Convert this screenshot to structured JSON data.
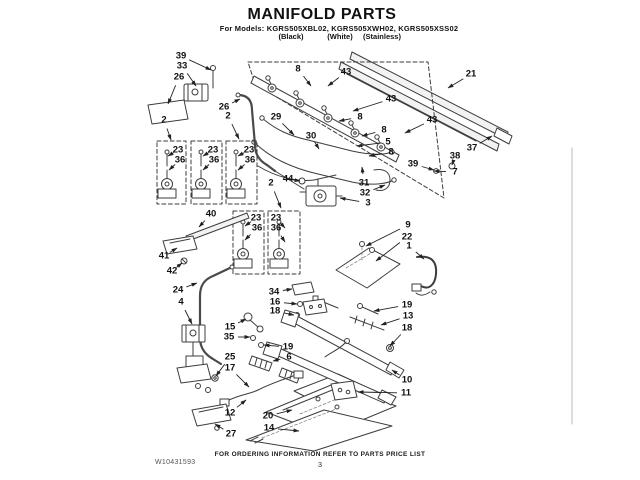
{
  "header": {
    "title": "MANIFOLD PARTS",
    "models_line": "For Models: KGRS505XBL02, KGRS505XWH02, KGRS505XSS02",
    "finishes": [
      "(Black)",
      "(White)",
      "(Stainless)"
    ]
  },
  "footer": {
    "ordering_note": "FOR ORDERING INFORMATION REFER TO PARTS PRICE LIST",
    "page_number": "3",
    "document_number": "W10431593"
  },
  "diagram": {
    "callouts": [
      {
        "label": "39",
        "x": 181,
        "y": 56,
        "tx": 211,
        "ty": 70
      },
      {
        "label": "33",
        "x": 182,
        "y": 66,
        "tx": 196,
        "ty": 86
      },
      {
        "label": "26",
        "x": 179,
        "y": 77,
        "tx": 168,
        "ty": 104
      },
      {
        "label": "26",
        "x": 224,
        "y": 107,
        "tx": 240,
        "ty": 99
      },
      {
        "label": "2",
        "x": 164,
        "y": 120,
        "tx": 171,
        "ty": 140
      },
      {
        "label": "2",
        "x": 228,
        "y": 116,
        "tx": 239,
        "ty": 139
      },
      {
        "label": "8",
        "x": 298,
        "y": 69,
        "tx": 311,
        "ty": 86
      },
      {
        "label": "43",
        "x": 346,
        "y": 72,
        "tx": 328,
        "ty": 86
      },
      {
        "label": "21",
        "x": 471,
        "y": 74,
        "tx": 448,
        "ty": 88
      },
      {
        "label": "43",
        "x": 391,
        "y": 99,
        "tx": 353,
        "ty": 111
      },
      {
        "label": "8",
        "x": 360,
        "y": 117,
        "tx": 339,
        "ty": 121
      },
      {
        "label": "43",
        "x": 432,
        "y": 120,
        "tx": 405,
        "ty": 133
      },
      {
        "label": "8",
        "x": 384,
        "y": 130,
        "tx": 362,
        "ty": 136
      },
      {
        "label": "5",
        "x": 388,
        "y": 142,
        "tx": 357,
        "ty": 146
      },
      {
        "label": "8",
        "x": 391,
        "y": 152,
        "tx": 369,
        "ty": 156
      },
      {
        "label": "29",
        "x": 276,
        "y": 117,
        "tx": 294,
        "ty": 135
      },
      {
        "label": "30",
        "x": 311,
        "y": 136,
        "tx": 319,
        "ty": 149
      },
      {
        "label": "39",
        "x": 413,
        "y": 164,
        "tx": 434,
        "ty": 170
      },
      {
        "label": "38",
        "x": 455,
        "y": 156,
        "tx": 452,
        "ty": 165
      },
      {
        "label": "37",
        "x": 472,
        "y": 148,
        "tx": 492,
        "ty": 136
      },
      {
        "label": "7",
        "x": 455,
        "y": 172,
        "tx": 434,
        "ty": 171
      },
      {
        "label": "31",
        "x": 364,
        "y": 183,
        "tx": 362,
        "ty": 167
      },
      {
        "label": "32",
        "x": 365,
        "y": 193,
        "tx": 385,
        "ty": 185
      },
      {
        "label": "3",
        "x": 368,
        "y": 203,
        "tx": 340,
        "ty": 198
      },
      {
        "label": "44",
        "x": 288,
        "y": 179,
        "tx": 300,
        "ty": 181
      },
      {
        "label": "2",
        "x": 271,
        "y": 183,
        "tx": 281,
        "ty": 208
      },
      {
        "label": "23",
        "x": 178,
        "y": 150,
        "tx": 168,
        "ty": 156
      },
      {
        "label": "36",
        "x": 180,
        "y": 160,
        "tx": 169,
        "ty": 170
      },
      {
        "label": "23",
        "x": 213,
        "y": 150,
        "tx": 203,
        "ty": 156
      },
      {
        "label": "36",
        "x": 214,
        "y": 160,
        "tx": 203,
        "ty": 170
      },
      {
        "label": "23",
        "x": 249,
        "y": 150,
        "tx": 238,
        "ty": 156
      },
      {
        "label": "36",
        "x": 250,
        "y": 160,
        "tx": 238,
        "ty": 170
      },
      {
        "label": "23",
        "x": 256,
        "y": 218,
        "tx": 245,
        "ty": 226
      },
      {
        "label": "36",
        "x": 257,
        "y": 228,
        "tx": 245,
        "ty": 240
      },
      {
        "label": "23",
        "x": 276,
        "y": 218,
        "tx": 285,
        "ty": 228
      },
      {
        "label": "36",
        "x": 276,
        "y": 228,
        "tx": 285,
        "ty": 242
      },
      {
        "label": "40",
        "x": 211,
        "y": 214,
        "tx": 199,
        "ty": 227
      },
      {
        "label": "41",
        "x": 164,
        "y": 256,
        "tx": 177,
        "ty": 248
      },
      {
        "label": "42",
        "x": 172,
        "y": 271,
        "tx": 182,
        "ty": 263
      },
      {
        "label": "24",
        "x": 178,
        "y": 290,
        "tx": 197,
        "ty": 283
      },
      {
        "label": "4",
        "x": 181,
        "y": 302,
        "tx": 192,
        "ty": 324
      },
      {
        "label": "9",
        "x": 408,
        "y": 225,
        "tx": 366,
        "ty": 246
      },
      {
        "label": "22",
        "x": 407,
        "y": 237,
        "tx": 376,
        "ty": 261
      },
      {
        "label": "1",
        "x": 409,
        "y": 246,
        "tx": 424,
        "ty": 259
      },
      {
        "label": "34",
        "x": 274,
        "y": 292,
        "tx": 292,
        "ty": 289
      },
      {
        "label": "16",
        "x": 275,
        "y": 302,
        "tx": 297,
        "ty": 304
      },
      {
        "label": "18",
        "x": 275,
        "y": 311,
        "tx": 294,
        "ty": 315
      },
      {
        "label": "19",
        "x": 407,
        "y": 305,
        "tx": 374,
        "ty": 311
      },
      {
        "label": "13",
        "x": 408,
        "y": 316,
        "tx": 381,
        "ty": 325
      },
      {
        "label": "18",
        "x": 407,
        "y": 328,
        "tx": 390,
        "ty": 346
      },
      {
        "label": "15",
        "x": 230,
        "y": 327,
        "tx": 246,
        "ty": 319
      },
      {
        "label": "35",
        "x": 229,
        "y": 337,
        "tx": 250,
        "ty": 337
      },
      {
        "label": "19",
        "x": 288,
        "y": 347,
        "tx": 264,
        "ty": 345
      },
      {
        "label": "6",
        "x": 289,
        "y": 357,
        "tx": 273,
        "ty": 361
      },
      {
        "label": "25",
        "x": 230,
        "y": 357,
        "tx": 216,
        "ty": 376
      },
      {
        "label": "17",
        "x": 230,
        "y": 368,
        "tx": 249,
        "ty": 387
      },
      {
        "label": "10",
        "x": 407,
        "y": 380,
        "tx": 392,
        "ty": 370
      },
      {
        "label": "11",
        "x": 406,
        "y": 393,
        "tx": 358,
        "ty": 392
      },
      {
        "label": "12",
        "x": 230,
        "y": 413,
        "tx": 246,
        "ty": 400
      },
      {
        "label": "27",
        "x": 231,
        "y": 434,
        "tx": 215,
        "ty": 424
      },
      {
        "label": "20",
        "x": 268,
        "y": 416,
        "tx": 292,
        "ty": 410
      },
      {
        "label": "14",
        "x": 269,
        "y": 428,
        "tx": 299,
        "ty": 431
      }
    ]
  }
}
